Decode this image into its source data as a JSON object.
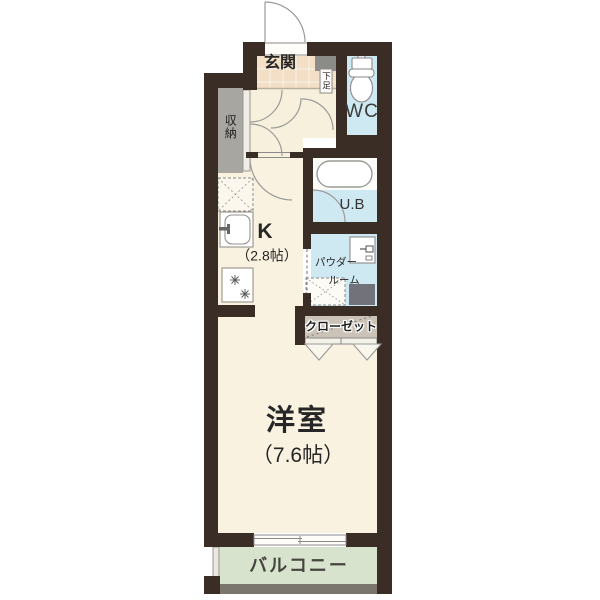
{
  "plan_title": "1K apartment floor plan",
  "rooms": {
    "genkan": {
      "label": "玄関"
    },
    "shoe_cabinet": {
      "label": "下足"
    },
    "wc": {
      "label": "WC"
    },
    "storage": {
      "label": "収納"
    },
    "kitchen": {
      "label": "K",
      "size": "（2.8帖）"
    },
    "unit_bath": {
      "label": "U.B"
    },
    "powder_room": {
      "label_line1": "パウダー",
      "label_line2": "ルーム"
    },
    "closet": {
      "label": "クローゼット"
    },
    "western_room": {
      "label": "洋室",
      "size": "（7.6帖）"
    },
    "balcony": {
      "label": "バルコニー"
    }
  },
  "colors": {
    "wall": "#3a2d25",
    "floor_cream": "#f9f2e0",
    "hall_cream": "#f7f0dc",
    "genkan_tile": "#f3dfc6",
    "water_blue": "#cfe9f2",
    "balcony_green": "#d8e3cd",
    "storage_gray": "#a7a6a1",
    "closet_tan": "#cbc3b8",
    "cabinet_gray": "#8b8b88",
    "appliance_gray": "#72727a",
    "railing_gray": "#7b766d"
  },
  "icons": {
    "entrance_door": "quarter-arc swing door",
    "toilet": "tank + bowl",
    "bathtub": "rounded rectangle",
    "washbasin": "square basin with faucet",
    "washing_machine_space": "dashed box with X",
    "refrigerator_space": "dashed box with X",
    "kitchen_sink": "counter with sink",
    "stove_burners": "two burner sparks",
    "sliding_window": "double sash lines",
    "closet_folding_doors": "two V chevrons"
  }
}
